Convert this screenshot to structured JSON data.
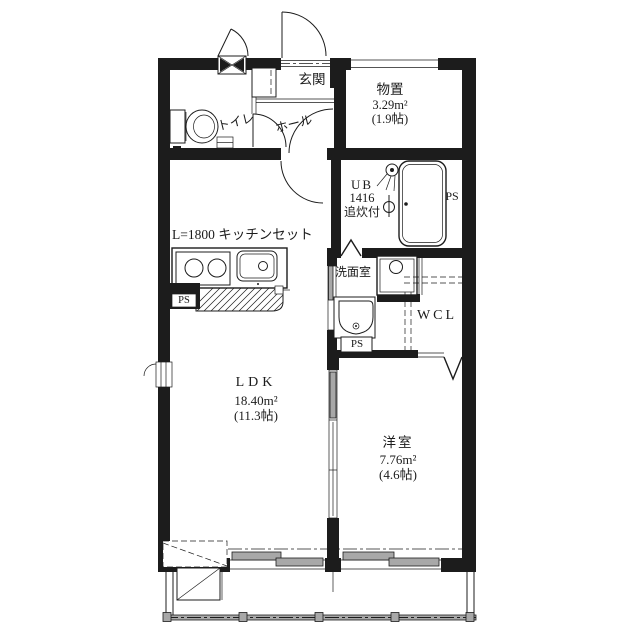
{
  "floorplan": {
    "entrance": {
      "label": "玄関"
    },
    "storage": {
      "label": "物置",
      "area": "3.29m²",
      "tatami": "(1.9帖)"
    },
    "toilet": {
      "label": "トイレ"
    },
    "hall": {
      "label": "ホール"
    },
    "bath": {
      "line1": "UB",
      "line2": "1416",
      "line3": "追炊付"
    },
    "washroom": {
      "label": "洗面室"
    },
    "closet": {
      "label": "WCL"
    },
    "kitchen": {
      "label": "L=1800 キッチンセット"
    },
    "ldk": {
      "label": "LDK",
      "area": "18.40m²",
      "tatami": "(11.3帖)"
    },
    "bedroom": {
      "label": "洋室",
      "area": "7.76m²",
      "tatami": "(4.6帖)"
    },
    "pipe_spaces": {
      "bath_ps": "PS",
      "kitchen_ps": "PS",
      "washroom_ps": "PS"
    },
    "colors": {
      "line": "#1c1c1c",
      "panel_gray": "#a8a8a8"
    }
  }
}
